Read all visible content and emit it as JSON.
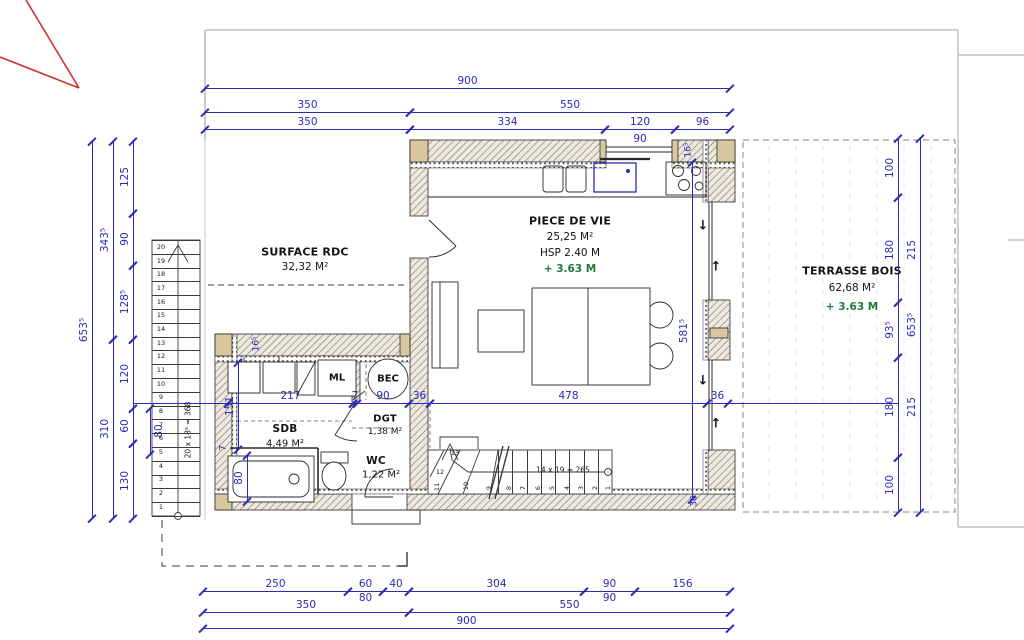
{
  "title": "Plan RDC - rez de chaussee",
  "colors": {
    "dimension": "#2b2bb5",
    "level_green": "#1d7a3c",
    "neighbor_red": "#cf3030",
    "wall_post_tan": "#d9c7a0",
    "boundary_gray": "#b9b9b9"
  },
  "rooms": {
    "surface_rdc": {
      "name": "SURFACE RDC",
      "area": "32,32 M²"
    },
    "piece_de_vie": {
      "name": "PIECE DE VIE",
      "area": "25,25 M²",
      "hsp": "HSP 2.40 M",
      "level": "+ 3.63 M"
    },
    "terrasse": {
      "name": "TERRASSE BOIS",
      "area": "62,68 M²",
      "level": "+ 3.63 M"
    },
    "sdb": {
      "name": "SDB",
      "area": "4,49 M²"
    },
    "wc": {
      "name": "WC",
      "area": "1,22 M²"
    },
    "dgt": {
      "name": "DGT",
      "area": "1,38 M²"
    },
    "ml": {
      "name": "ML"
    },
    "bec": {
      "name": "BEC"
    }
  },
  "stairs": {
    "left": {
      "note": "20 x 18⁵ = 368",
      "count": 20
    },
    "bottom": {
      "note": "14 x 19 = 265",
      "count": 14
    }
  },
  "dims": [
    {
      "o": "h",
      "x": 205,
      "y": 88,
      "l": 525,
      "v": "900"
    },
    {
      "o": "h",
      "x": 205,
      "y": 112,
      "l": 205,
      "v": "350"
    },
    {
      "o": "h",
      "x": 410,
      "y": 112,
      "l": 320,
      "v": "550"
    },
    {
      "o": "h",
      "x": 205,
      "y": 129,
      "l": 205,
      "v": "350"
    },
    {
      "o": "h",
      "x": 410,
      "y": 129,
      "l": 195,
      "v": "334"
    },
    {
      "o": "h",
      "x": 605,
      "y": 129,
      "l": 70,
      "v": "120"
    },
    {
      "o": "h",
      "x": 675,
      "y": 129,
      "l": 55,
      "v": "96"
    },
    {
      "o": "h",
      "x": 605,
      "y": 130,
      "l": 70,
      "v": "90",
      "s": "b",
      "nl": 1
    },
    {
      "o": "v",
      "x": 92,
      "y": 141,
      "l": 377,
      "v": "653⁵"
    },
    {
      "o": "v",
      "x": 113,
      "y": 141,
      "l": 198,
      "v": "343⁵"
    },
    {
      "o": "v",
      "x": 113,
      "y": 339,
      "l": 179,
      "v": "310"
    },
    {
      "o": "v",
      "x": 133,
      "y": 141,
      "l": 72,
      "v": "125"
    },
    {
      "o": "v",
      "x": 133,
      "y": 213,
      "l": 52,
      "v": "90"
    },
    {
      "o": "v",
      "x": 133,
      "y": 265,
      "l": 74,
      "v": "128⁵"
    },
    {
      "o": "v",
      "x": 133,
      "y": 339,
      "l": 69,
      "v": "120"
    },
    {
      "o": "v",
      "x": 133,
      "y": 408,
      "l": 35,
      "v": "60"
    },
    {
      "o": "v",
      "x": 133,
      "y": 443,
      "l": 75,
      "v": "130"
    },
    {
      "o": "v",
      "x": 150,
      "y": 408,
      "l": 46,
      "v": "80",
      "s": "b"
    },
    {
      "o": "v",
      "x": 898,
      "y": 138,
      "l": 59,
      "v": "100"
    },
    {
      "o": "v",
      "x": 898,
      "y": 197,
      "l": 105,
      "v": "180"
    },
    {
      "o": "v",
      "x": 898,
      "y": 302,
      "l": 55,
      "v": "93⁵"
    },
    {
      "o": "v",
      "x": 898,
      "y": 357,
      "l": 100,
      "v": "180"
    },
    {
      "o": "v",
      "x": 898,
      "y": 457,
      "l": 55,
      "v": "100"
    },
    {
      "o": "v",
      "x": 920,
      "y": 138,
      "l": 374,
      "v": "653⁵"
    },
    {
      "o": "v",
      "x": 920,
      "y": 197,
      "l": 105,
      "v": "215",
      "nl": 1
    },
    {
      "o": "v",
      "x": 920,
      "y": 357,
      "l": 100,
      "v": "215",
      "nl": 1
    },
    {
      "o": "h",
      "x": 203,
      "y": 591,
      "l": 145,
      "v": "250"
    },
    {
      "o": "h",
      "x": 348,
      "y": 591,
      "l": 35,
      "v": "60"
    },
    {
      "o": "h",
      "x": 383,
      "y": 591,
      "l": 26,
      "v": "40"
    },
    {
      "o": "h",
      "x": 409,
      "y": 591,
      "l": 175,
      "v": "304"
    },
    {
      "o": "h",
      "x": 584,
      "y": 591,
      "l": 51,
      "v": "90"
    },
    {
      "o": "h",
      "x": 635,
      "y": 591,
      "l": 95,
      "v": "156"
    },
    {
      "o": "h",
      "x": 348,
      "y": 589,
      "l": 35,
      "v": "80",
      "s": "b",
      "nl": 1
    },
    {
      "o": "h",
      "x": 584,
      "y": 589,
      "l": 51,
      "v": "90",
      "s": "b",
      "nl": 1
    },
    {
      "o": "h",
      "x": 203,
      "y": 612,
      "l": 206,
      "v": "350"
    },
    {
      "o": "h",
      "x": 409,
      "y": 612,
      "l": 321,
      "v": "550"
    },
    {
      "o": "h",
      "x": 203,
      "y": 628,
      "l": 527,
      "v": "900"
    },
    {
      "o": "h",
      "x": 133,
      "y": 403,
      "l": 95,
      "v": "",
      "nt": 1
    },
    {
      "o": "h",
      "x": 228,
      "y": 403,
      "l": 125,
      "v": "217"
    },
    {
      "o": "h",
      "x": 353,
      "y": 403,
      "l": 4,
      "v": "7"
    },
    {
      "o": "h",
      "x": 357,
      "y": 403,
      "l": 52,
      "v": "90"
    },
    {
      "o": "h",
      "x": 409,
      "y": 403,
      "l": 21,
      "v": "36"
    },
    {
      "o": "h",
      "x": 430,
      "y": 403,
      "l": 277,
      "v": "478"
    },
    {
      "o": "h",
      "x": 707,
      "y": 403,
      "l": 21,
      "v": "36"
    },
    {
      "o": "h",
      "x": 728,
      "y": 403,
      "l": 170,
      "v": "",
      "nt": 1
    },
    {
      "o": "v",
      "x": 238,
      "y": 362,
      "l": 87,
      "v": "151"
    },
    {
      "o": "v",
      "x": 692,
      "y": 162,
      "l": 337,
      "v": "581⁵"
    },
    {
      "o": "v",
      "x": 247,
      "y": 455,
      "l": 46,
      "v": "80"
    }
  ],
  "texts": [
    {
      "x": 257,
      "y": 344,
      "v": "16⁵",
      "r": 1,
      "c": "dim"
    },
    {
      "x": 689,
      "y": 150,
      "v": "16⁵",
      "r": 1,
      "c": "dim"
    },
    {
      "x": 224,
      "y": 448,
      "v": "7",
      "r": 1,
      "c": "dim"
    },
    {
      "x": 695,
      "y": 501,
      "v": "36",
      "r": 1,
      "c": "dim"
    },
    {
      "x": 188,
      "y": 430,
      "v": "20 x 18⁵ = 368",
      "r": 1,
      "c": "note"
    },
    {
      "x": 563,
      "y": 470,
      "v": "14 x 19 = 265",
      "c": "note"
    },
    {
      "x": 703,
      "y": 226,
      "v": "↓",
      "c": "arrow"
    },
    {
      "x": 716,
      "y": 267,
      "v": "↑",
      "c": "arrow"
    },
    {
      "x": 703,
      "y": 381,
      "v": "↓",
      "c": "arrow"
    },
    {
      "x": 716,
      "y": 424,
      "v": "↑",
      "c": "arrow"
    },
    {
      "x": 455,
      "y": 453,
      "v": "13",
      "c": "stp"
    },
    {
      "x": 440,
      "y": 472,
      "v": "12",
      "c": "stp"
    },
    {
      "x": 437,
      "y": 487,
      "v": "11",
      "c": "stp",
      "r": 1
    },
    {
      "x": 466,
      "y": 486,
      "v": "10",
      "c": "stp",
      "r": 1
    },
    {
      "x": 489,
      "y": 488,
      "v": "9",
      "c": "stp",
      "r": 1
    },
    {
      "x": 509,
      "y": 488,
      "v": "8",
      "c": "stp",
      "r": 1
    },
    {
      "x": 523,
      "y": 488,
      "v": "7",
      "c": "stp",
      "r": 1
    },
    {
      "x": 538,
      "y": 488,
      "v": "6",
      "c": "stp",
      "r": 1
    },
    {
      "x": 552,
      "y": 488,
      "v": "5",
      "c": "stp",
      "r": 1
    },
    {
      "x": 567,
      "y": 488,
      "v": "4",
      "c": "stp",
      "r": 1
    },
    {
      "x": 581,
      "y": 488,
      "v": "3",
      "c": "stp",
      "r": 1
    },
    {
      "x": 595,
      "y": 488,
      "v": "2",
      "c": "stp",
      "r": 1
    },
    {
      "x": 608,
      "y": 488,
      "v": "1",
      "c": "stp",
      "r": 1
    }
  ]
}
